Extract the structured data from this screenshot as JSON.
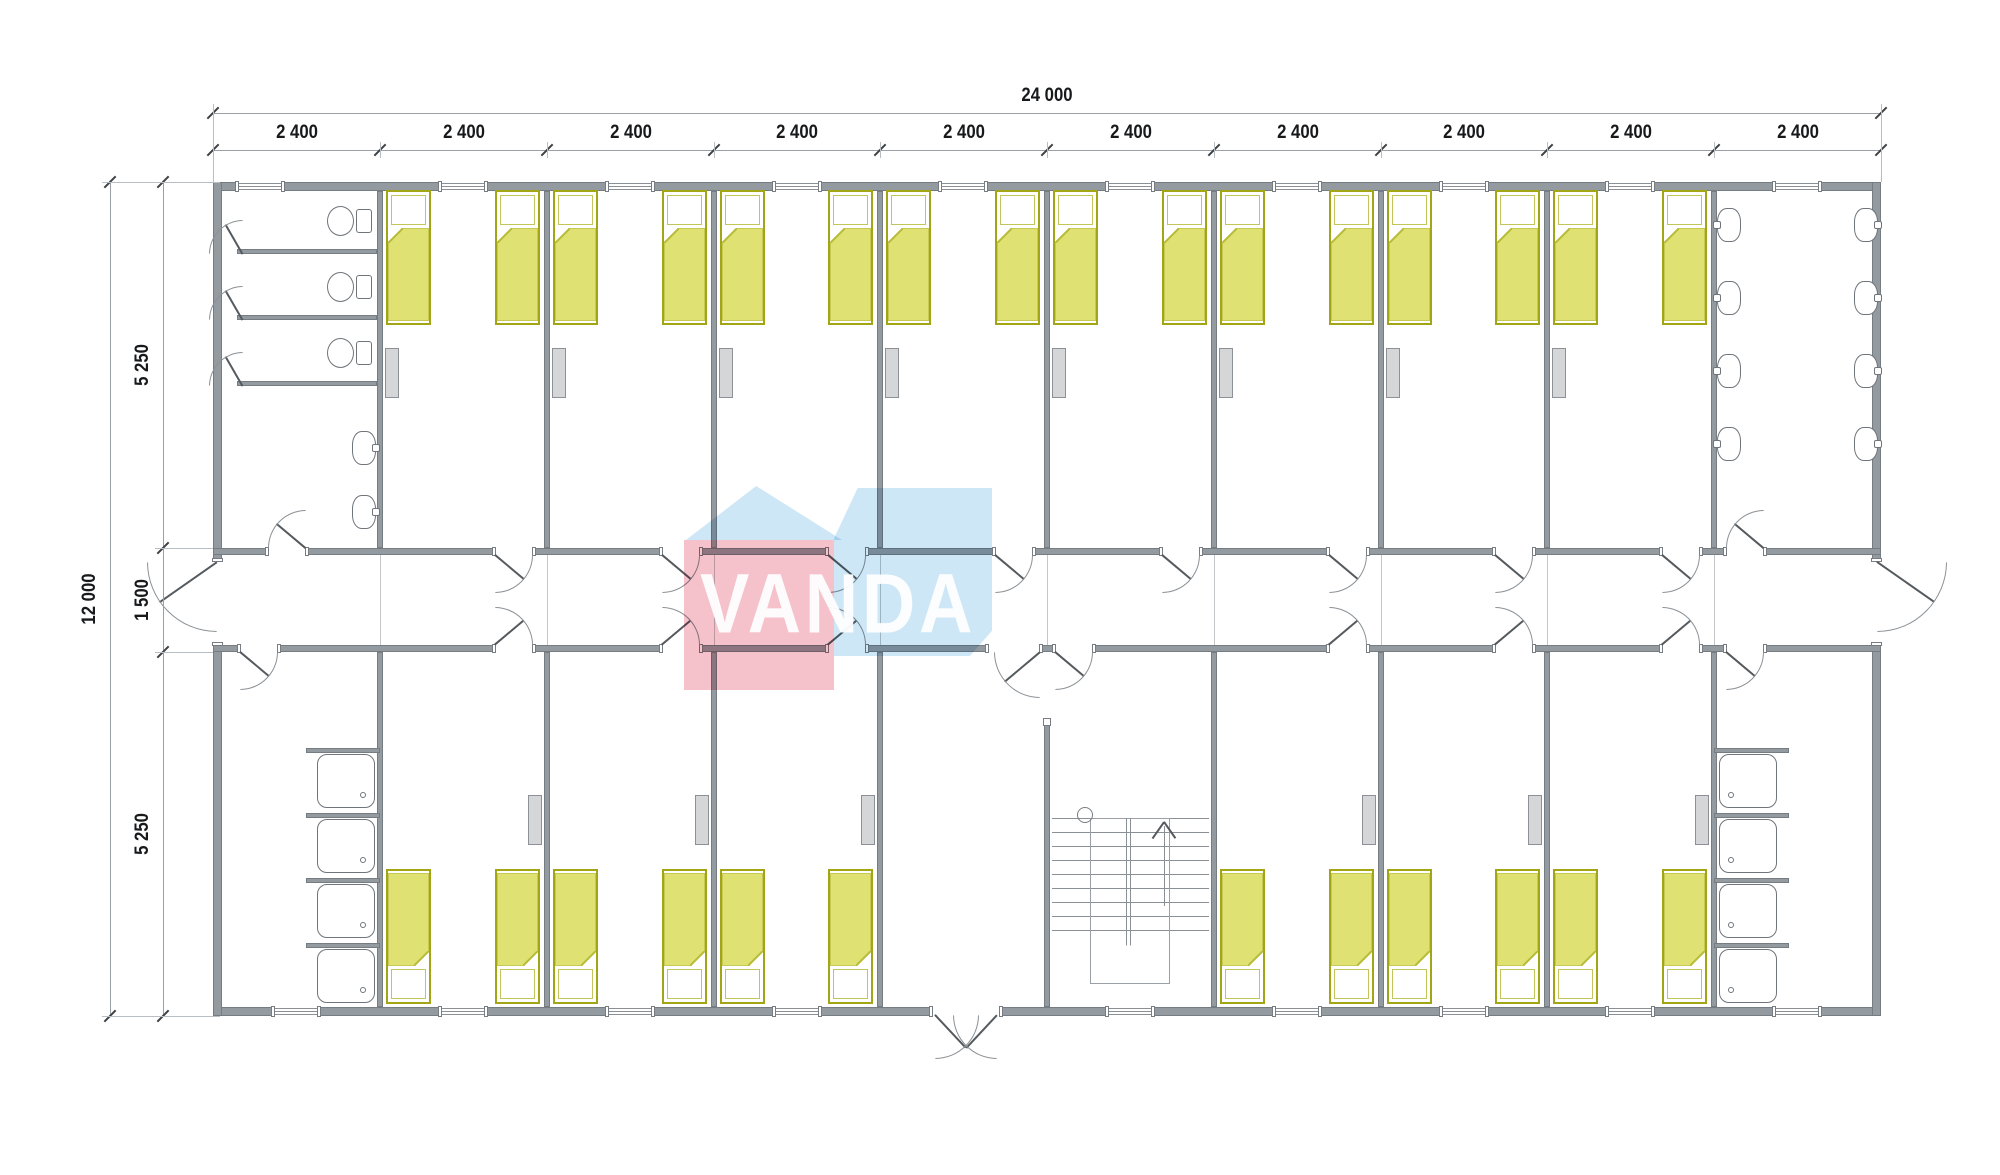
{
  "watermark": {
    "text": "VANDA",
    "pink_color": "#ec8a9b",
    "blue_color": "#a6d4ef"
  },
  "dimensions": {
    "overall_width": "24 000",
    "overall_height": "12 000",
    "module_widths": [
      "2 400",
      "2 400",
      "2 400",
      "2 400",
      "2 400",
      "2 400",
      "2 400",
      "2 400",
      "2 400",
      "2 400"
    ],
    "height_segments": [
      "5 250",
      "1 500",
      "5 250"
    ]
  },
  "plan": {
    "type": "floor-plan",
    "building": {
      "length_mm": 24000,
      "width_mm": 12000,
      "modules": 10,
      "module_width_mm": 2400
    },
    "corridor": {
      "width_mm": 1500,
      "exits": [
        "left",
        "right"
      ]
    },
    "top_row": [
      {
        "room": "toilet-room",
        "toilets": 3,
        "washbasins": 2
      },
      {
        "room": "bedroom",
        "count": 8,
        "beds_each": 2,
        "lockers_each": 1
      },
      {
        "room": "washroom",
        "washbasins": 8
      }
    ],
    "bottom_row": [
      {
        "room": "shower-room",
        "showers": 4
      },
      {
        "room": "bedroom",
        "count": 3,
        "beds_each": 2,
        "lockers_each": 1
      },
      {
        "room": "entrance-hall",
        "exterior_double_door": true
      },
      {
        "room": "staircase",
        "direction": "up"
      },
      {
        "room": "bedroom",
        "count": 3,
        "beds_each": 2,
        "lockers_each": 1
      },
      {
        "room": "shower-room",
        "showers": 4
      }
    ],
    "fixture_totals": {
      "beds": 28,
      "toilets": 3,
      "washbasins": 10,
      "showers": 8,
      "lockers": 14,
      "windows": 19
    }
  },
  "colors": {
    "wall": "#939aa0",
    "bed_fill": "#dfe273",
    "bed_border": "#a2a614",
    "locker": "#d4d6d8",
    "dimension_text": "#17191b"
  }
}
